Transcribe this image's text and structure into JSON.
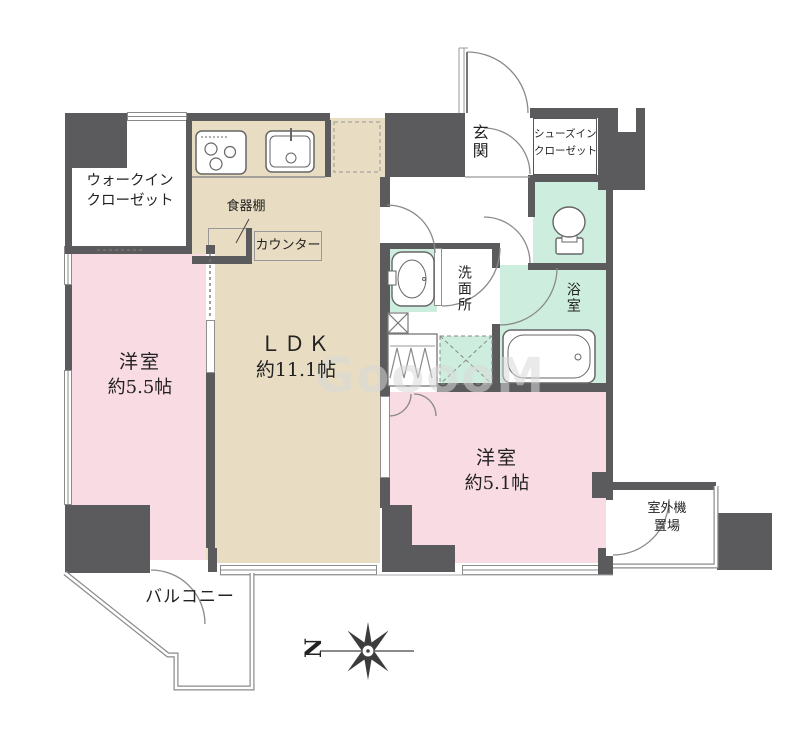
{
  "rooms": {
    "walk_in_closet": {
      "line1": "ウォークイン",
      "line2": "クローゼット"
    },
    "ldk": {
      "name": "ＬＤＫ",
      "size": "約11.1帖"
    },
    "bedroom_55": {
      "name": "洋室",
      "size": "約5.5帖"
    },
    "bedroom_51": {
      "name": "洋室",
      "size": "約5.1帖"
    },
    "genkan": {
      "name": "玄関"
    },
    "shoes_closet": {
      "line1": "シューズイン",
      "line2": "クローゼット"
    },
    "washroom": {
      "name": "洗面所"
    },
    "bathroom": {
      "name": "浴室"
    },
    "balcony": {
      "name": "バルコニー"
    },
    "outdoor_unit": {
      "line1": "室外機",
      "line2": "置場"
    },
    "dish_shelf": {
      "name": "食器棚"
    },
    "counter": {
      "name": "カウンター"
    }
  },
  "compass": {
    "north_label": "N"
  },
  "watermark": {
    "text": "GooooM"
  },
  "colors": {
    "wall": "#5b5b5d",
    "ldk": "#e8dcc2",
    "pink": "#f9dbe4",
    "mint": "#cdeede",
    "line": "#8a8a8a",
    "label": "#222222",
    "wm": "#d9d9d9"
  }
}
